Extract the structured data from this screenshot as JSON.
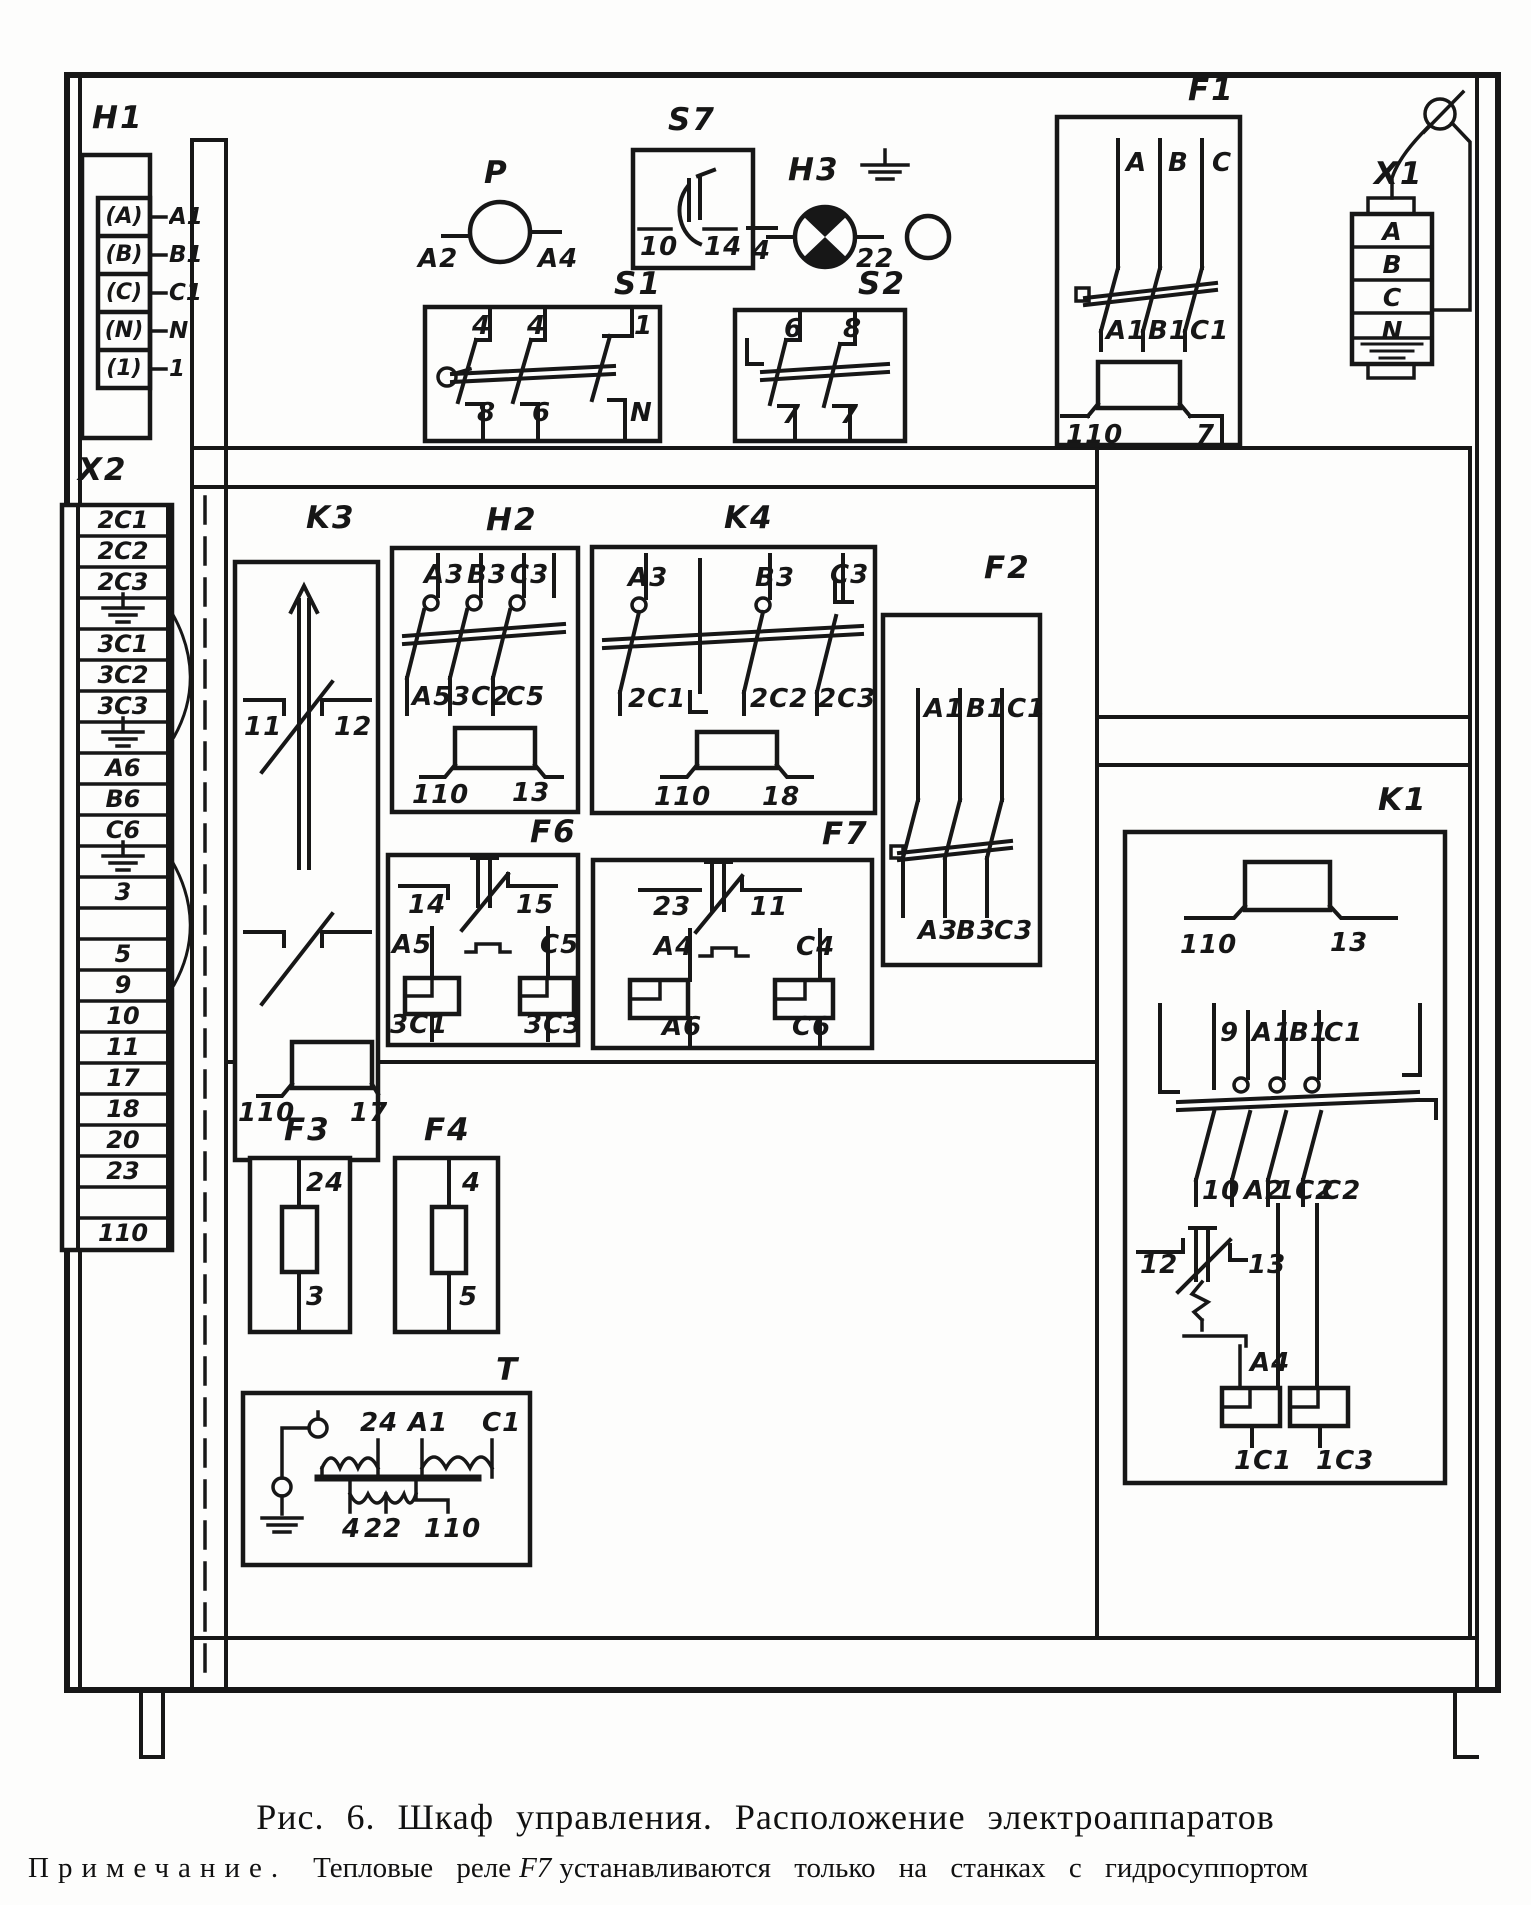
{
  "figure": {
    "caption": "Рис. 6. Шкаф управления. Расположение электроаппаратов",
    "note_label": "Примечание.",
    "note_body": "Тепловые реле",
    "note_emph": "F7",
    "note_tail": "устанавливаются только на станках с гидросуппортом"
  },
  "components": {
    "h1": {
      "label": "H1",
      "cells": [
        "(A)",
        "(B)",
        "(C)",
        "(N)",
        "(1)"
      ],
      "pins": [
        "A1",
        "B1",
        "C1",
        "N",
        "1"
      ]
    },
    "x2": {
      "label": "X2",
      "rows": [
        "2C1",
        "2C2",
        "2C3",
        "",
        "3C1",
        "3C2",
        "3C3",
        "",
        "A6",
        "B6",
        "C6",
        "",
        "3",
        "",
        "5",
        "9",
        "10",
        "11",
        "17",
        "18",
        "20",
        "23",
        "",
        "110"
      ]
    },
    "p": {
      "label": "P",
      "pin_left": "A2",
      "pin_right": "A4"
    },
    "s7": {
      "label": "S7",
      "pin_left": "10",
      "pin_right": "14"
    },
    "h3": {
      "label": "H3",
      "pin_left": "4",
      "pin_right": "22"
    },
    "s1": {
      "label": "S1",
      "top": [
        "4",
        "4",
        "1"
      ],
      "bottom": [
        "8",
        "6",
        "N"
      ]
    },
    "s2": {
      "label": "S2",
      "top": [
        "6",
        "8"
      ],
      "bottom": [
        "7",
        "7"
      ]
    },
    "f1": {
      "label": "F1",
      "top": [
        "A",
        "B",
        "C"
      ],
      "mid": [
        "A1",
        "B1",
        "C1"
      ],
      "coil": [
        "110",
        "7"
      ]
    },
    "x1": {
      "label": "X1",
      "cells": [
        "A",
        "B",
        "C",
        "N"
      ]
    },
    "k3": {
      "label": "K3",
      "pin_left": "11",
      "pin_right": "12",
      "coil": [
        "110",
        "17"
      ]
    },
    "h2": {
      "label": "H2",
      "top": [
        "A3",
        "B3",
        "C3"
      ],
      "mid": [
        "A5",
        "3C2",
        "C5"
      ],
      "coil": [
        "110",
        "13"
      ]
    },
    "k4": {
      "label": "K4",
      "top": [
        "A3",
        "B3",
        "C3"
      ],
      "mid": [
        "2C1",
        "2C2",
        "2C3"
      ],
      "coil": [
        "110",
        "18"
      ]
    },
    "f2": {
      "label": "F2",
      "top": [
        "A1",
        "B1",
        "C1"
      ],
      "bottom": [
        "A3",
        "B3",
        "C3"
      ]
    },
    "f6": {
      "label": "F6",
      "top": [
        "14",
        "15"
      ],
      "mid": [
        "A5",
        "C5"
      ],
      "bottom": [
        "3C1",
        "3C3"
      ]
    },
    "f7": {
      "label": "F7",
      "top": [
        "23",
        "11"
      ],
      "mid": [
        "A4",
        "C4"
      ],
      "bottom": [
        "A6",
        "C6"
      ]
    },
    "f3": {
      "label": "F3",
      "top": "24",
      "bottom": "3"
    },
    "f4": {
      "label": "F4",
      "top": "4",
      "bottom": "5"
    },
    "t": {
      "label": "T",
      "top": [
        "24",
        "A1",
        "C1"
      ],
      "bottom": [
        "4",
        "22",
        "110"
      ]
    },
    "k1": {
      "label": "K1",
      "coil": [
        "110",
        "13"
      ],
      "top": [
        "9",
        "A1",
        "B1",
        "C1"
      ],
      "mid": [
        "10",
        "A2",
        "1C2",
        "C2"
      ],
      "thermal": [
        "12",
        "13"
      ],
      "aux": "A4",
      "bottom": [
        "1C1",
        "1C3"
      ]
    }
  }
}
